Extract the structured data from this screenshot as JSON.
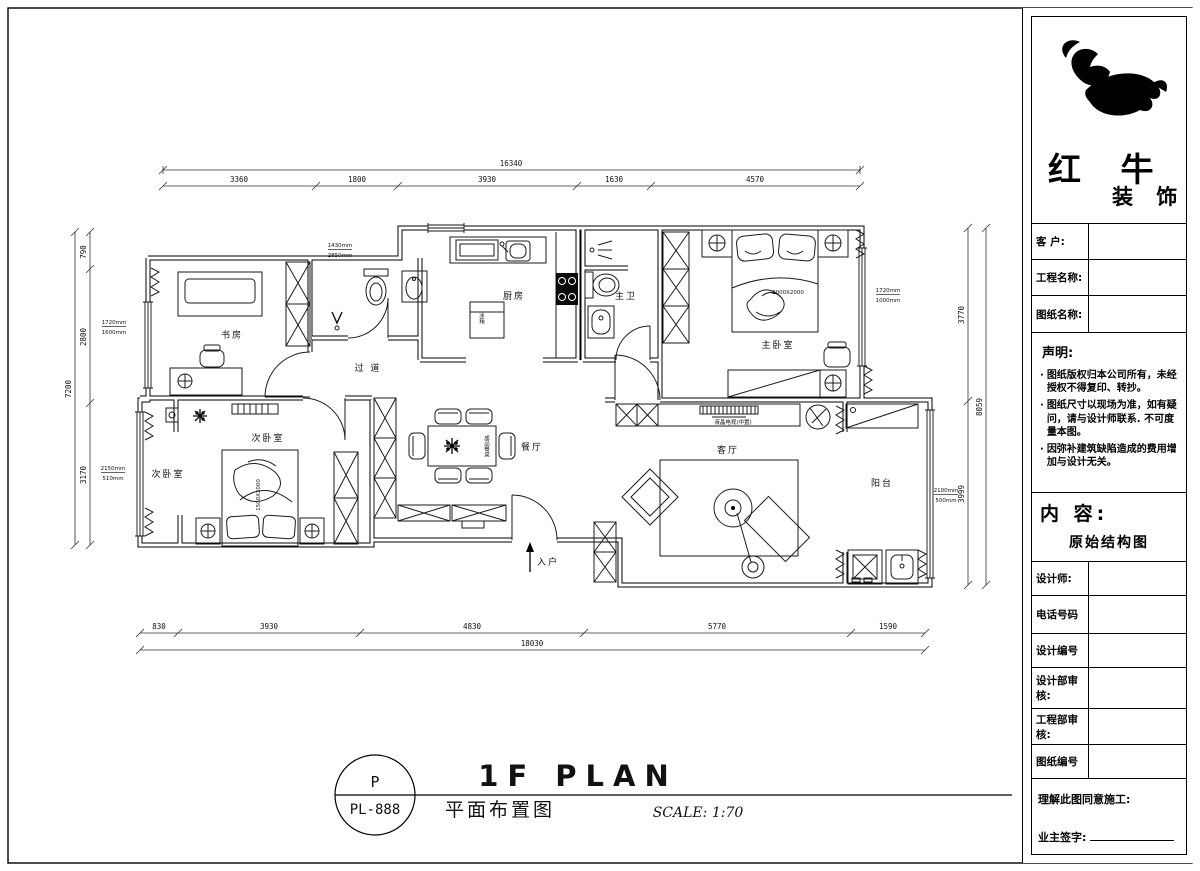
{
  "company": {
    "name_top": "红 牛",
    "name_bottom": "装 饰"
  },
  "title_block": {
    "fields": [
      {
        "label": "客  户:",
        "value": ""
      },
      {
        "label": "工程名称:",
        "value": ""
      },
      {
        "label": "图纸名称:",
        "value": ""
      }
    ],
    "statement": {
      "heading": "声明:",
      "items": [
        "图纸版权归本公司所有，未经授权不得复印、转抄。",
        "图纸尺寸以现场为准，如有疑问，请与设计师联系. 不可度量本图。",
        "因弥补建筑缺陷造成的费用增加与设计无关。"
      ]
    },
    "content": {
      "label": "内 容:",
      "value": "原始结构图"
    },
    "fields2": [
      {
        "label": "设计师:",
        "value": ""
      },
      {
        "label": "电话号码",
        "value": ""
      },
      {
        "label": "设计编号",
        "value": ""
      },
      {
        "label": "设计部审核:",
        "value": ""
      },
      {
        "label": "工程部审核:",
        "value": ""
      },
      {
        "label": "图纸编号",
        "value": ""
      }
    ],
    "signature": {
      "line1": "理解此图同意施工:",
      "line2": "业主签字:"
    }
  },
  "drawing_title": {
    "stamp_top": "P",
    "stamp_bottom": "PL-888",
    "main": "1F PLAN",
    "sub": "平面布置图",
    "scale": "SCALE: 1:70"
  },
  "plan": {
    "rooms": {
      "study": "书房",
      "corridor": "过 道",
      "kitchen": "厨房",
      "master_bath": "主卫",
      "master_bedroom": "主卧室",
      "second_bedroom_a": "次卧室",
      "second_bedroom_b": "次卧室",
      "dining": "餐厅",
      "living": "客厅",
      "balcony": "阳台",
      "entry": "入户"
    },
    "furniture_labels": {
      "fridge": "冰箱",
      "tv": "液晶电视(中置)",
      "master_bed_size": "2000X2000",
      "second_bed_size": "1500X2000",
      "dining_table": "成品餐桌"
    },
    "annotations": {
      "study_window": {
        "top": "1720mm",
        "bottom": "1600mm"
      },
      "bath_wall": {
        "top": "1430mm",
        "bottom": "2850mm"
      },
      "master_window": {
        "top": "1720mm",
        "bottom": "1000mm"
      },
      "bedroom2_window": {
        "top": "2150mm",
        "bottom": "510mm"
      },
      "balcony_window": {
        "top": "2100mm",
        "bottom": "500mm"
      }
    },
    "dims": {
      "top": {
        "overall": "16340",
        "segments": [
          "3360",
          "1800",
          "3930",
          "1630",
          "4570"
        ]
      },
      "bottom": {
        "overall": "18030",
        "segments": [
          "830",
          "3930",
          "4830",
          "5770",
          "1590"
        ]
      },
      "left": {
        "overall": "7200",
        "segments": [
          "790",
          "2800",
          "3170"
        ]
      },
      "right": {
        "overall": "8059",
        "segments": [
          "3770",
          "3999"
        ]
      }
    }
  }
}
